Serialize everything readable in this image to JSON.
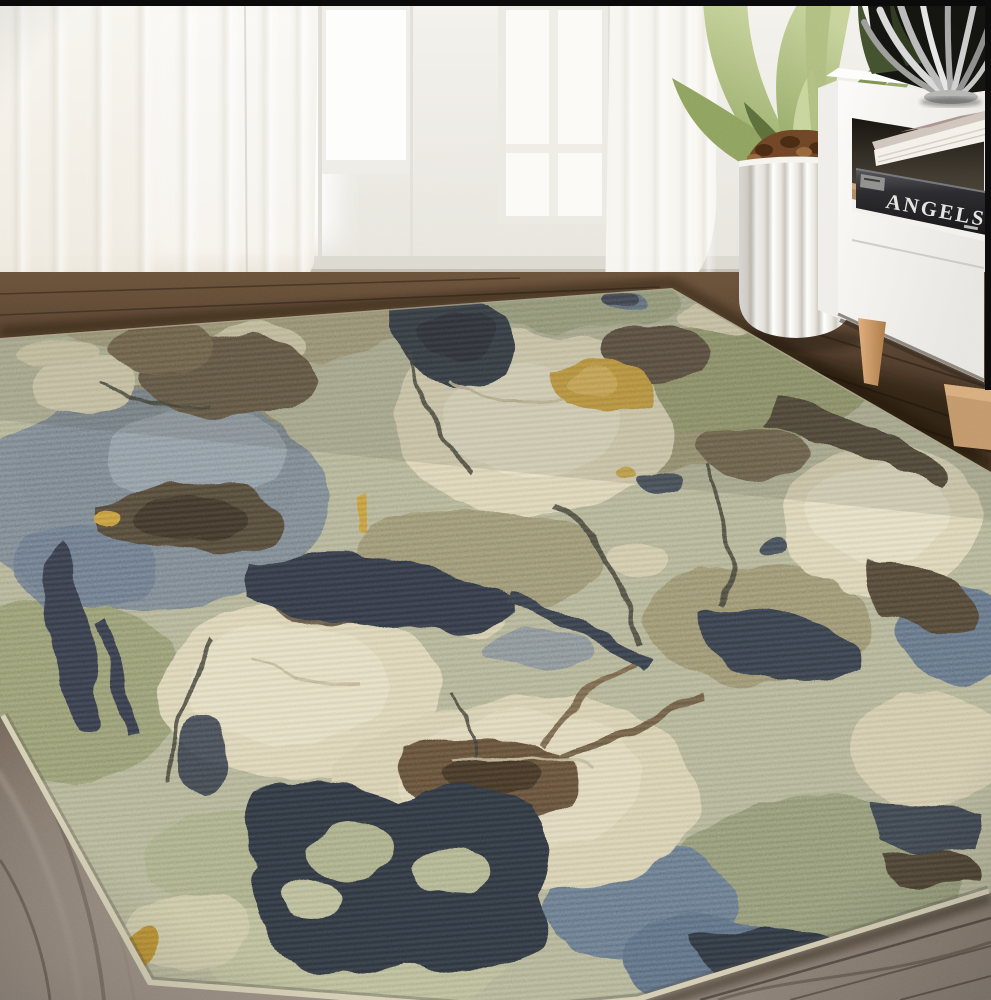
{
  "meta": {
    "type": "lifestyle product photograph",
    "subject": "abstract multicolor area rug staged in a bright living room",
    "dimensions": "991x1000"
  },
  "room": {
    "wall": "white wall with sheer floor-length curtains",
    "windows": [
      "bright window glow behind left curtain",
      "white door window pane",
      "white framed window with mullions"
    ],
    "curtain_panels": [
      "left sheer curtain pooling on floor",
      "center sheer curtain pooling on floor"
    ],
    "floor": "dark walnut wood planks fading to gray-taupe boards in the foreground"
  },
  "furniture": {
    "cabinet": {
      "description": "white low TV cabinet with open shelf and tapered wood legs",
      "book_spine_text": "ANGELS",
      "books": [
        "white coffee-table book",
        "black hardcover titled ANGELS"
      ],
      "decor_object": "silver ribbed decorative bowl"
    },
    "planter": {
      "description": "white fluted round planter",
      "plant": "green agave-style plant",
      "fill": "brown bark chips"
    }
  },
  "rug": {
    "style": "abstract painterly stone / marble pattern, distressed woven texture",
    "placement": "angled across the floor toward the camera",
    "colors": {
      "base_sage": "#b1b392",
      "cream": "#ded6b6",
      "khaki": "#a09876",
      "denim_blue": "#75828e",
      "steel_blue": "#93a0aa",
      "navy": "#2e3540",
      "dark_brown": "#4c4234",
      "rich_brown": "#5f4c36",
      "gold_accent": "#c79a3b",
      "edge_binding": "#d6d0b6"
    }
  },
  "palette": {
    "wall": "#f0eee9",
    "curtain": "#f6f3ed",
    "floor_dark": "#4a392b",
    "floor_gray": "#8d8177",
    "cabinet_white": "#f7f6f3",
    "leg_wood": "#d2a070",
    "shelf_wood": "#b08a5e",
    "bowl_silver": "#c9c9c7",
    "leaf_green": "#a3b174",
    "soil_brown": "#6e4526",
    "frame_bar": "#0a0a0a"
  }
}
